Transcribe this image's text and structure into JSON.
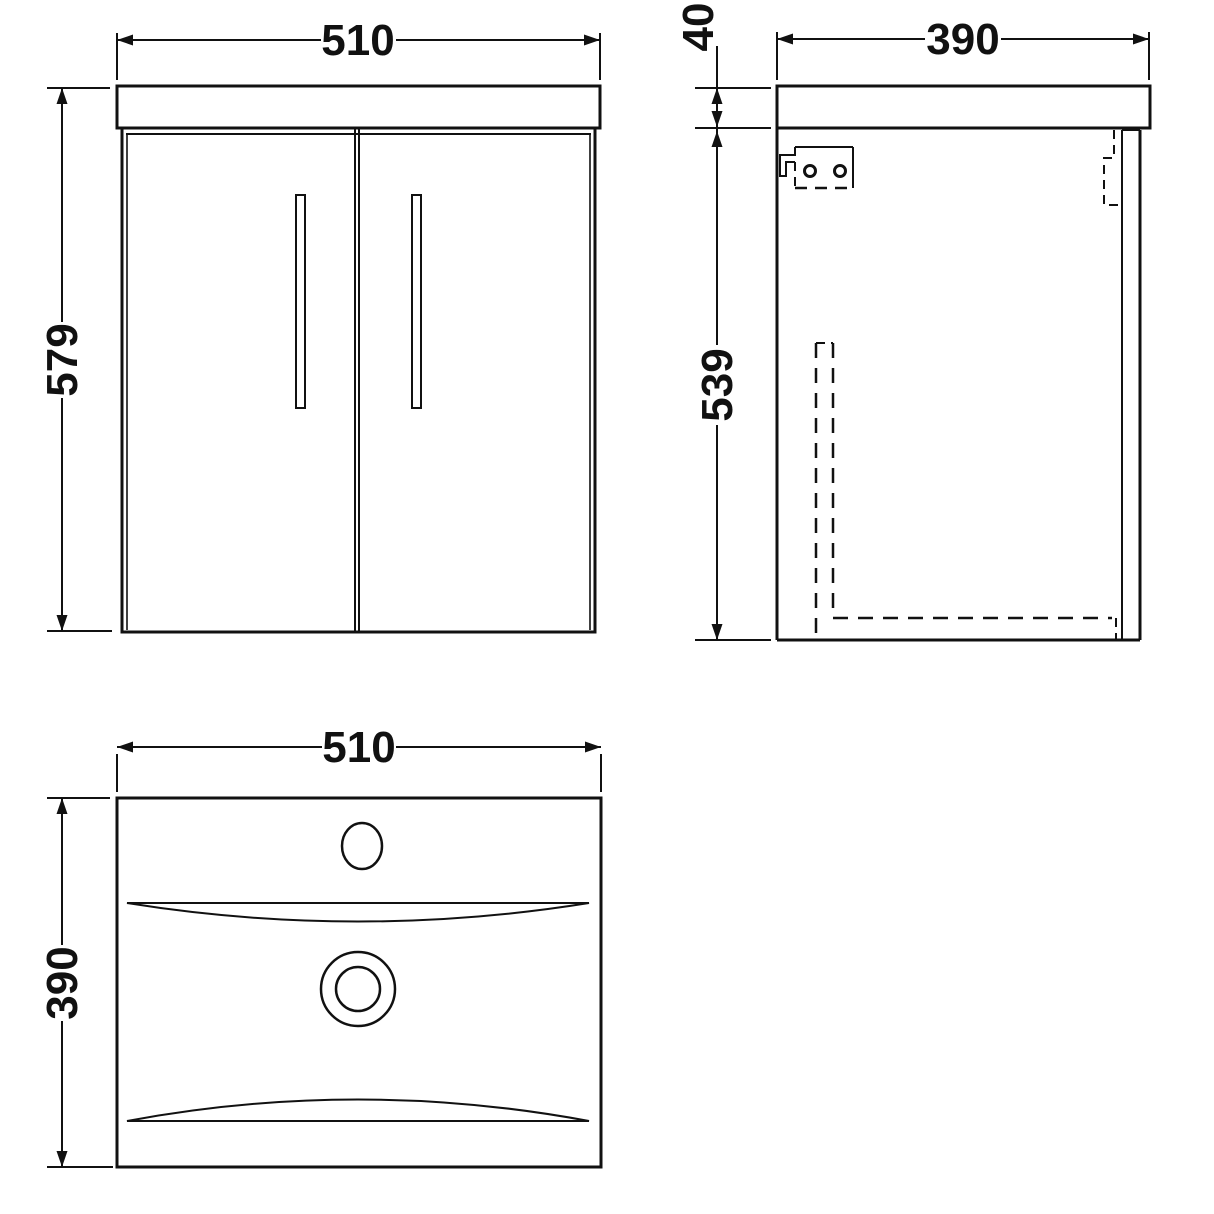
{
  "drawing": {
    "description": "vanity-unit-technical-drawing",
    "colors": {
      "background": "#ffffff",
      "line": "#111111"
    },
    "dimensions": {
      "front_width": "510",
      "front_height": "579",
      "side_depth": "390",
      "counter_thickness": "40",
      "side_height": "539",
      "plan_width": "510",
      "plan_depth": "390"
    }
  }
}
